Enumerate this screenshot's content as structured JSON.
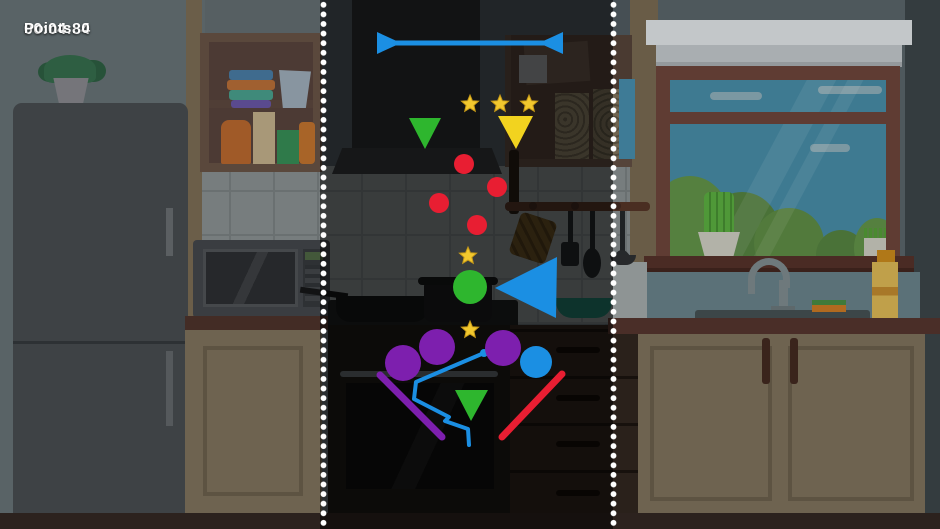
{
  "hud": {
    "points": "Points: 0",
    "timer": "00:04:84"
  },
  "colors": {
    "blue": "#1b8fe3",
    "green": "#2eb62e",
    "yellow": "#f2d31f",
    "red": "#e81e32",
    "purple": "#7d1fae",
    "star": "#f2c82e",
    "dotted_line": "#ffffff"
  },
  "game": {
    "double_arrow": {
      "name": "blue-double-arrow-bar",
      "color": "blue",
      "line": [
        392,
        43,
        548,
        43
      ],
      "width": 5,
      "left_tri": [
        377,
        32,
        377,
        54,
        401,
        43
      ],
      "right_tri": [
        563,
        32,
        563,
        54,
        539,
        43
      ]
    },
    "stars": [
      {
        "x": 470,
        "y": 104,
        "r": 9
      },
      {
        "x": 500,
        "y": 104,
        "r": 9
      },
      {
        "x": 529,
        "y": 104,
        "r": 9
      },
      {
        "x": 468,
        "y": 256,
        "r": 9
      },
      {
        "x": 470,
        "y": 330,
        "r": 9
      }
    ],
    "triangles": [
      {
        "name": "green-triangle-top",
        "color": "green",
        "points": [
          409,
          118,
          441,
          118,
          425,
          149
        ]
      },
      {
        "name": "yellow-triangle",
        "color": "yellow",
        "points": [
          498,
          116,
          533,
          116,
          516,
          149
        ]
      },
      {
        "name": "blue-triangle-left",
        "color": "blue",
        "points": [
          557,
          257,
          556,
          318,
          495,
          288
        ]
      },
      {
        "name": "green-triangle-bottom",
        "color": "green",
        "points": [
          455,
          390,
          488,
          390,
          471,
          421
        ]
      }
    ],
    "circles": [
      {
        "name": "red-ball",
        "color": "red",
        "x": 464,
        "y": 164,
        "r": 10
      },
      {
        "name": "red-ball",
        "color": "red",
        "x": 497,
        "y": 187,
        "r": 10
      },
      {
        "name": "red-ball",
        "color": "red",
        "x": 439,
        "y": 203,
        "r": 10
      },
      {
        "name": "red-ball",
        "color": "red",
        "x": 477,
        "y": 225,
        "r": 10
      },
      {
        "name": "green-ball",
        "color": "green",
        "x": 470,
        "y": 287,
        "r": 17
      },
      {
        "name": "purple-ball",
        "color": "purple",
        "x": 403,
        "y": 363,
        "r": 18
      },
      {
        "name": "purple-ball",
        "color": "purple",
        "x": 437,
        "y": 347,
        "r": 18
      },
      {
        "name": "purple-ball",
        "color": "purple",
        "x": 503,
        "y": 348,
        "r": 18
      },
      {
        "name": "blue-ball",
        "color": "blue",
        "x": 536,
        "y": 362,
        "r": 16
      }
    ],
    "lines": [
      {
        "name": "purple-ramp",
        "color": "purple",
        "x1": 380,
        "y1": 375,
        "x2": 442,
        "y2": 437,
        "width": 7
      },
      {
        "name": "red-ramp",
        "color": "red",
        "x1": 502,
        "y1": 437,
        "x2": 562,
        "y2": 374,
        "width": 7
      }
    ],
    "polyline": {
      "name": "blue-drawn-path",
      "color": "blue",
      "width": 4,
      "points": [
        484,
        353,
        416,
        382,
        414,
        399,
        449,
        417,
        445,
        421,
        468,
        429,
        469,
        445
      ],
      "start_dot": {
        "x": 484,
        "y": 353,
        "r": 4
      }
    }
  }
}
